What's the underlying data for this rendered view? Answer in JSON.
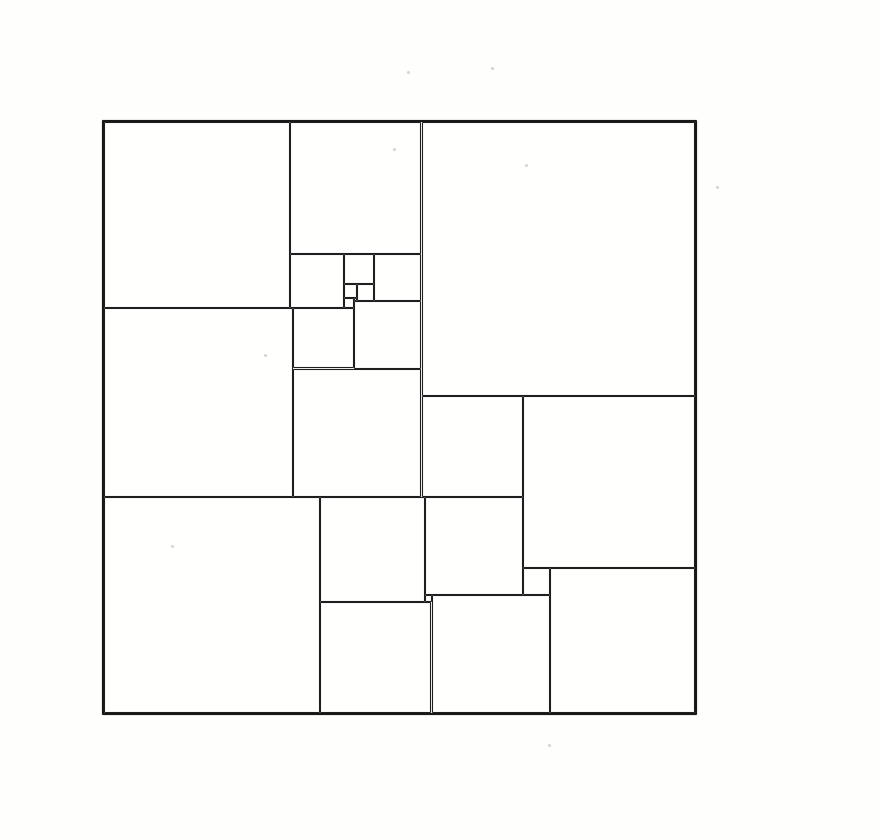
{
  "diagram": {
    "kind": "squared-square-dissection",
    "square_count": 24,
    "side_units": 175,
    "line_color": "#1e1e1e",
    "paper_color": "#fffffe",
    "squares": [
      {
        "size": 55,
        "x": 0,
        "y": 0
      },
      {
        "size": 39,
        "x": 55,
        "y": 0
      },
      {
        "size": 81,
        "x": 94,
        "y": 0
      },
      {
        "size": 16,
        "x": 55,
        "y": 39
      },
      {
        "size": 9,
        "x": 71,
        "y": 39
      },
      {
        "size": 14,
        "x": 80,
        "y": 39
      },
      {
        "size": 4,
        "x": 71,
        "y": 48
      },
      {
        "size": 5,
        "x": 75,
        "y": 48
      },
      {
        "size": 3,
        "x": 71,
        "y": 52
      },
      {
        "size": 1,
        "x": 74,
        "y": 52
      },
      {
        "size": 20,
        "x": 74,
        "y": 53
      },
      {
        "size": 56,
        "x": 0,
        "y": 55
      },
      {
        "size": 18,
        "x": 56,
        "y": 55
      },
      {
        "size": 38,
        "x": 56,
        "y": 73
      },
      {
        "size": 30,
        "x": 94,
        "y": 81
      },
      {
        "size": 51,
        "x": 124,
        "y": 81
      },
      {
        "size": 64,
        "x": 0,
        "y": 111
      },
      {
        "size": 31,
        "x": 64,
        "y": 111
      },
      {
        "size": 29,
        "x": 95,
        "y": 111
      },
      {
        "size": 8,
        "x": 124,
        "y": 132
      },
      {
        "size": 43,
        "x": 132,
        "y": 132
      },
      {
        "size": 2,
        "x": 95,
        "y": 140
      },
      {
        "size": 35,
        "x": 97,
        "y": 140
      },
      {
        "size": 33,
        "x": 64,
        "y": 142
      }
    ]
  },
  "specks": [
    {
      "x": 407,
      "y": 71
    },
    {
      "x": 491,
      "y": 67
    },
    {
      "x": 393,
      "y": 148
    },
    {
      "x": 525,
      "y": 164
    },
    {
      "x": 264,
      "y": 354
    },
    {
      "x": 171,
      "y": 545
    },
    {
      "x": 716,
      "y": 186
    },
    {
      "x": 548,
      "y": 744
    }
  ]
}
